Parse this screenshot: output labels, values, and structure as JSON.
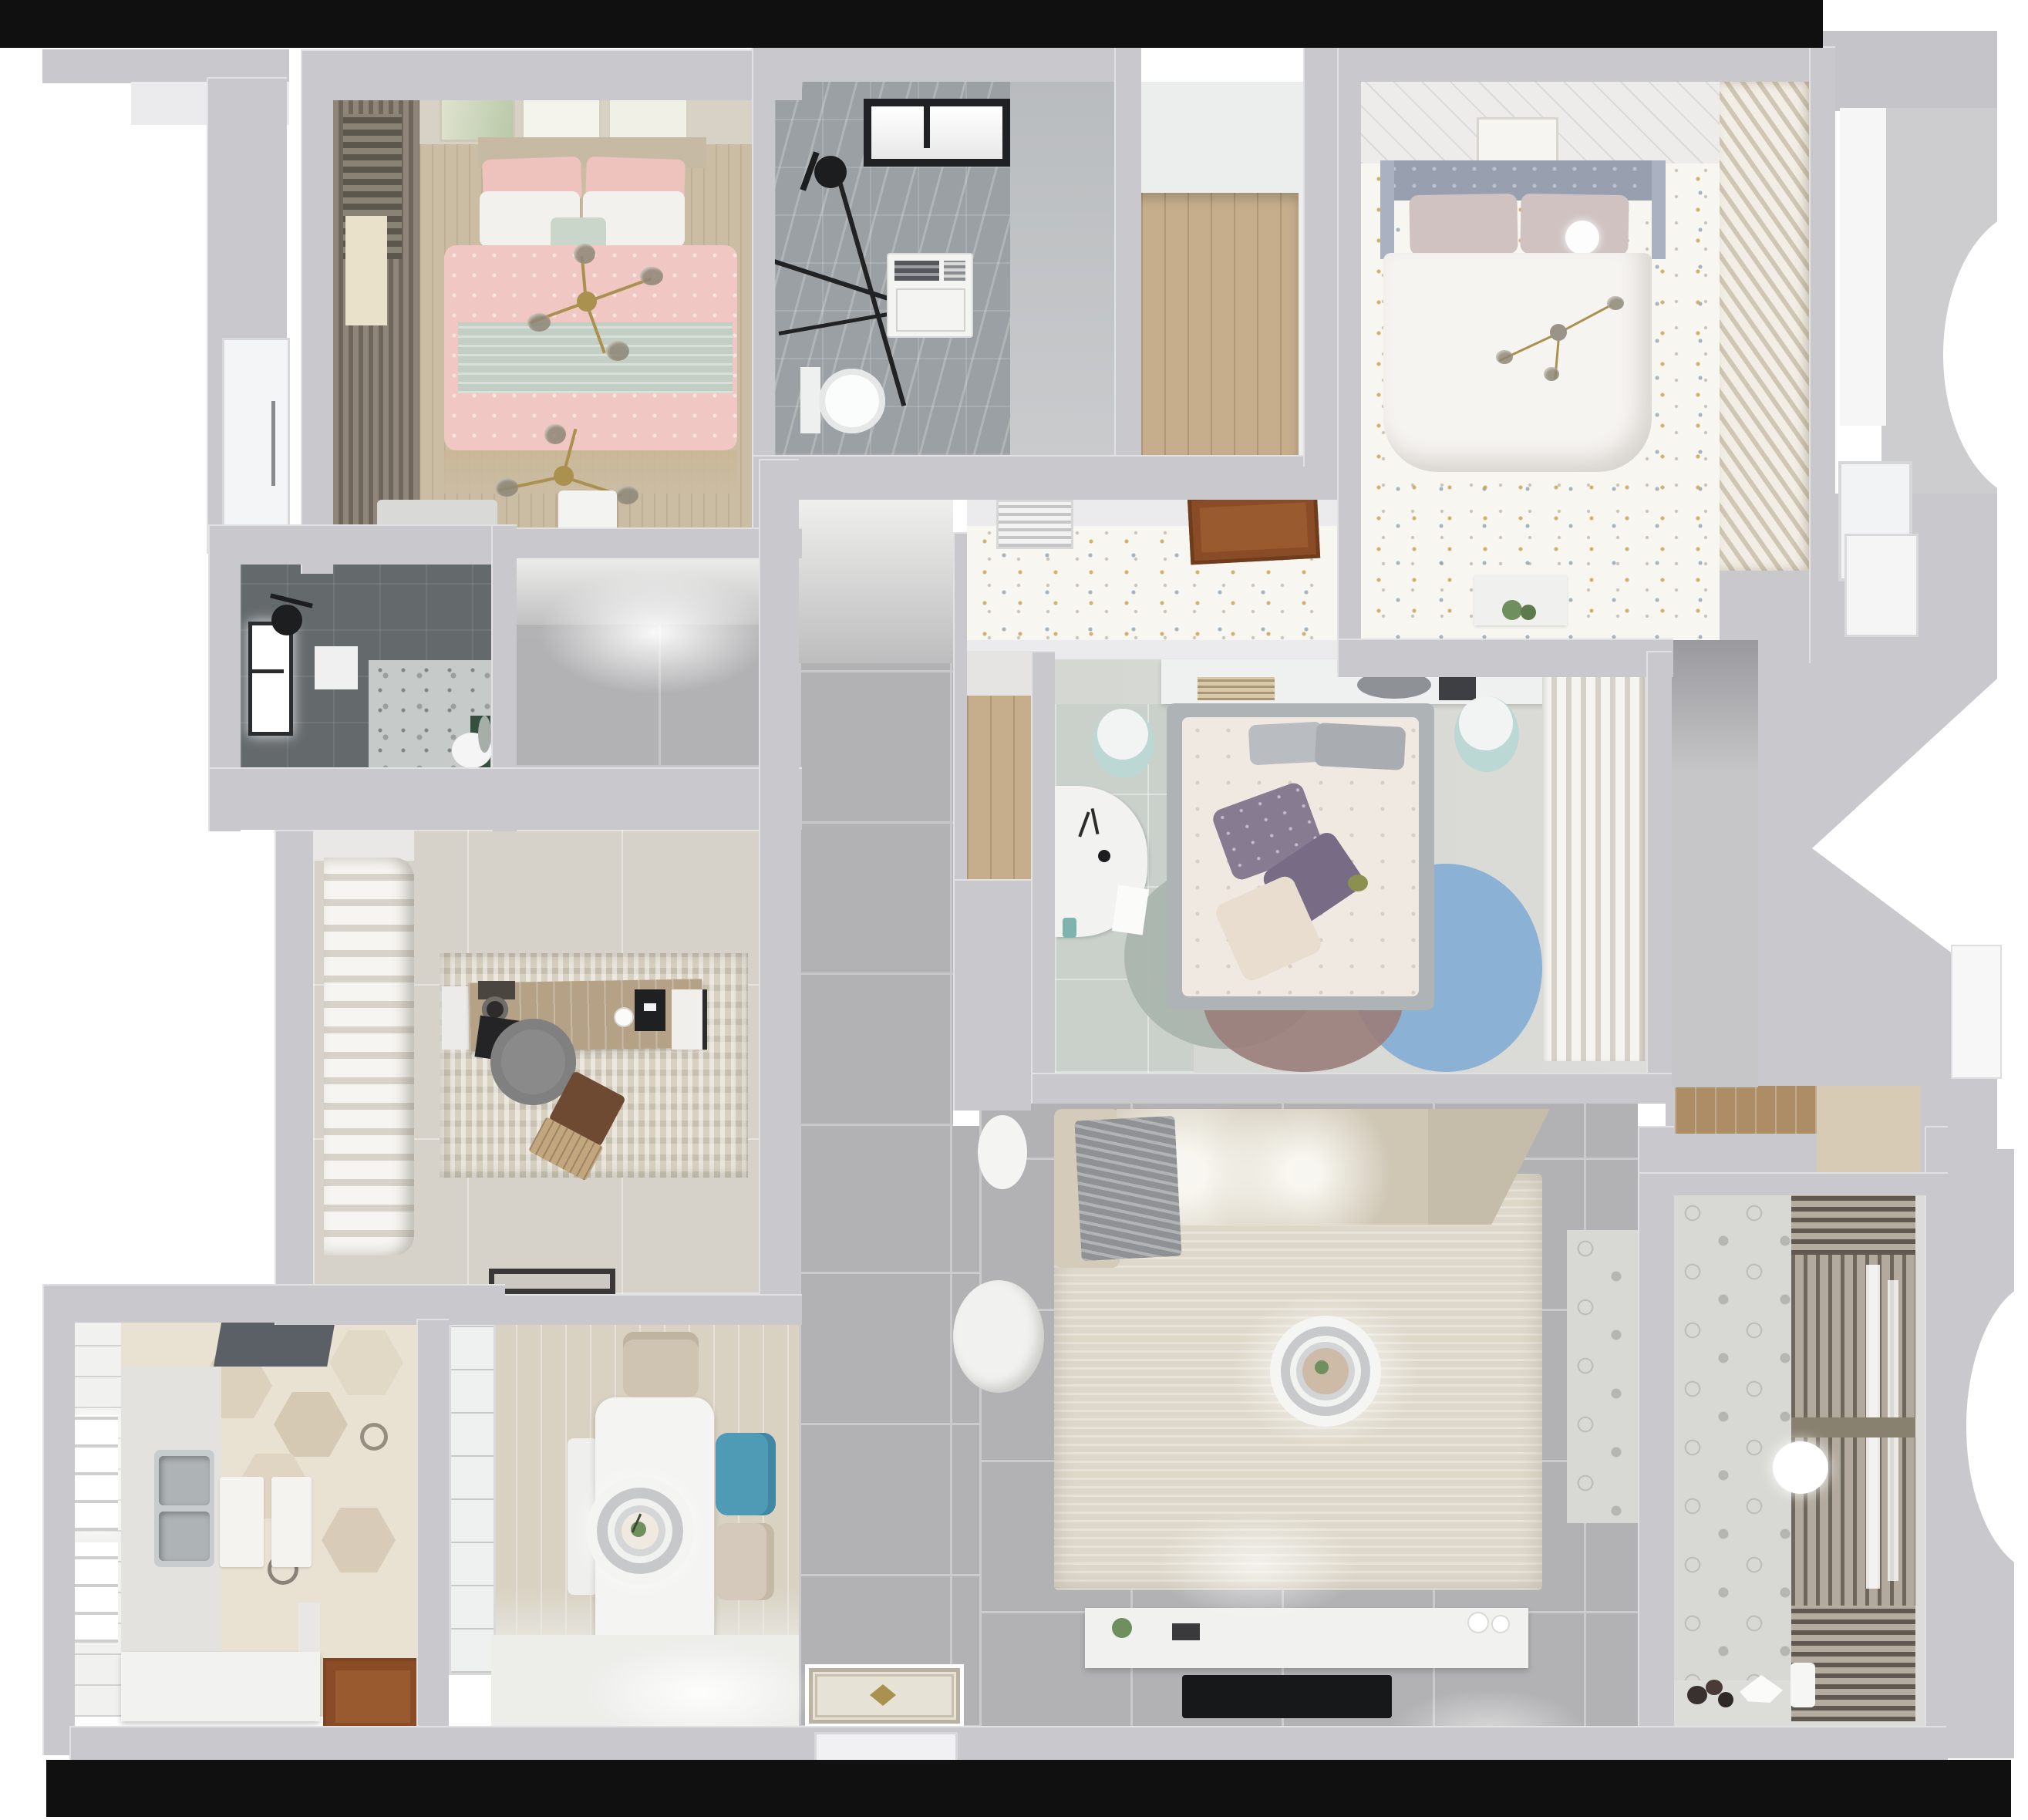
{
  "scene": {
    "type": "3d_floor_plan_top_view",
    "description": "Photorealistic top-down 3D render of a furnished apartment; no visible text in the image"
  },
  "palette": {
    "wall": "#c9c9cd",
    "wall_light": "#ebebed",
    "black": "#101010",
    "tile_gray": "#b2b2b4",
    "grout": "#cbcbcd",
    "floral": "#f8f6f1",
    "wood_floor": "#cbbda4",
    "wood_plank": "#c6ae8d",
    "wood_door": "#9a5a30",
    "marble": "#9aa0a4",
    "dark_tile": "#64696c",
    "hex_base": "#e9e2d3",
    "pink": "#f0c7c2",
    "sage": "#c3cfc5",
    "headboard_tan": "#c6baa5",
    "headboard_gray": "#98a0b0",
    "duvet": "#f6f4f1",
    "sofa": "#cfc6b4",
    "rug_living": "#ded8ca",
    "rug_study": "#d8d1c1",
    "blanket": "#8f9294",
    "teal": "#bcd8d4",
    "blue_chair": "#4f9ab5",
    "rug_blue": "#84aed4",
    "rug_mauve": "#9b7d7a",
    "rug_sage": "#a9b4ad",
    "purple": "#877b92",
    "gold": "#ab9150",
    "green_dark": "#35503f",
    "plant": "#6f8f5f",
    "radiator": "#a59d90",
    "slat": "#cfc6b3",
    "balcony_tile": "#d8d8d4",
    "study_floor": "#d6d2c9",
    "bed3_floor": "#d4d7d2",
    "dining_wood": "#d9d2c3"
  },
  "rooms": [
    {
      "id": "bedroom-pink",
      "label": "Bedroom with pink bedding, curtains, gold branch chandelier and wall art"
    },
    {
      "id": "bathroom-main",
      "label": "Main bathroom with black-framed window, shower, washer unit and toilet"
    },
    {
      "id": "closet-nook",
      "label": "Wood-floored closet nook"
    },
    {
      "id": "bedroom-master",
      "label": "Master bedroom with gray tufted headboard, white duvet, dotted floral floor and louvered wardrobe"
    },
    {
      "id": "bathroom-dark",
      "label": "Dark tiled shower bathroom with bright window and toilet"
    },
    {
      "id": "study",
      "label": "Study / cloakroom with open wardrobe, desk, office chair and rug"
    },
    {
      "id": "bedroom-second",
      "label": "Second bedroom with headboard shelf, desk, two poufs, round color-block rug and wardrobe"
    },
    {
      "id": "hallway",
      "label": "Gray-tiled hallway"
    },
    {
      "id": "kitchen",
      "label": "Kitchen with hexagon tile floor, double sink, range hood and white counters"
    },
    {
      "id": "dining",
      "label": "Dining area with white table, ring pendant lamp, blue and beige chairs"
    },
    {
      "id": "living",
      "label": "Living room with corner sofa, large rug, ring pendant lamp, TV console and TV"
    },
    {
      "id": "balcony",
      "label": "Balcony laundry with patterned cement tiles, drying rack radiator and ball lamp"
    }
  ],
  "furniture_legend": [
    "double-bed",
    "pillow",
    "duvet",
    "branch-chandelier",
    "ball-lamp",
    "ring-pendant-lamp",
    "sofa",
    "blanket",
    "rug",
    "tv",
    "tv-console",
    "dining-table",
    "chair",
    "pouf",
    "desk",
    "office-chair",
    "wardrobe",
    "sink",
    "range-hood",
    "toilet",
    "shower-head",
    "window",
    "door",
    "doormat",
    "radiator-rack",
    "planter",
    "books"
  ]
}
